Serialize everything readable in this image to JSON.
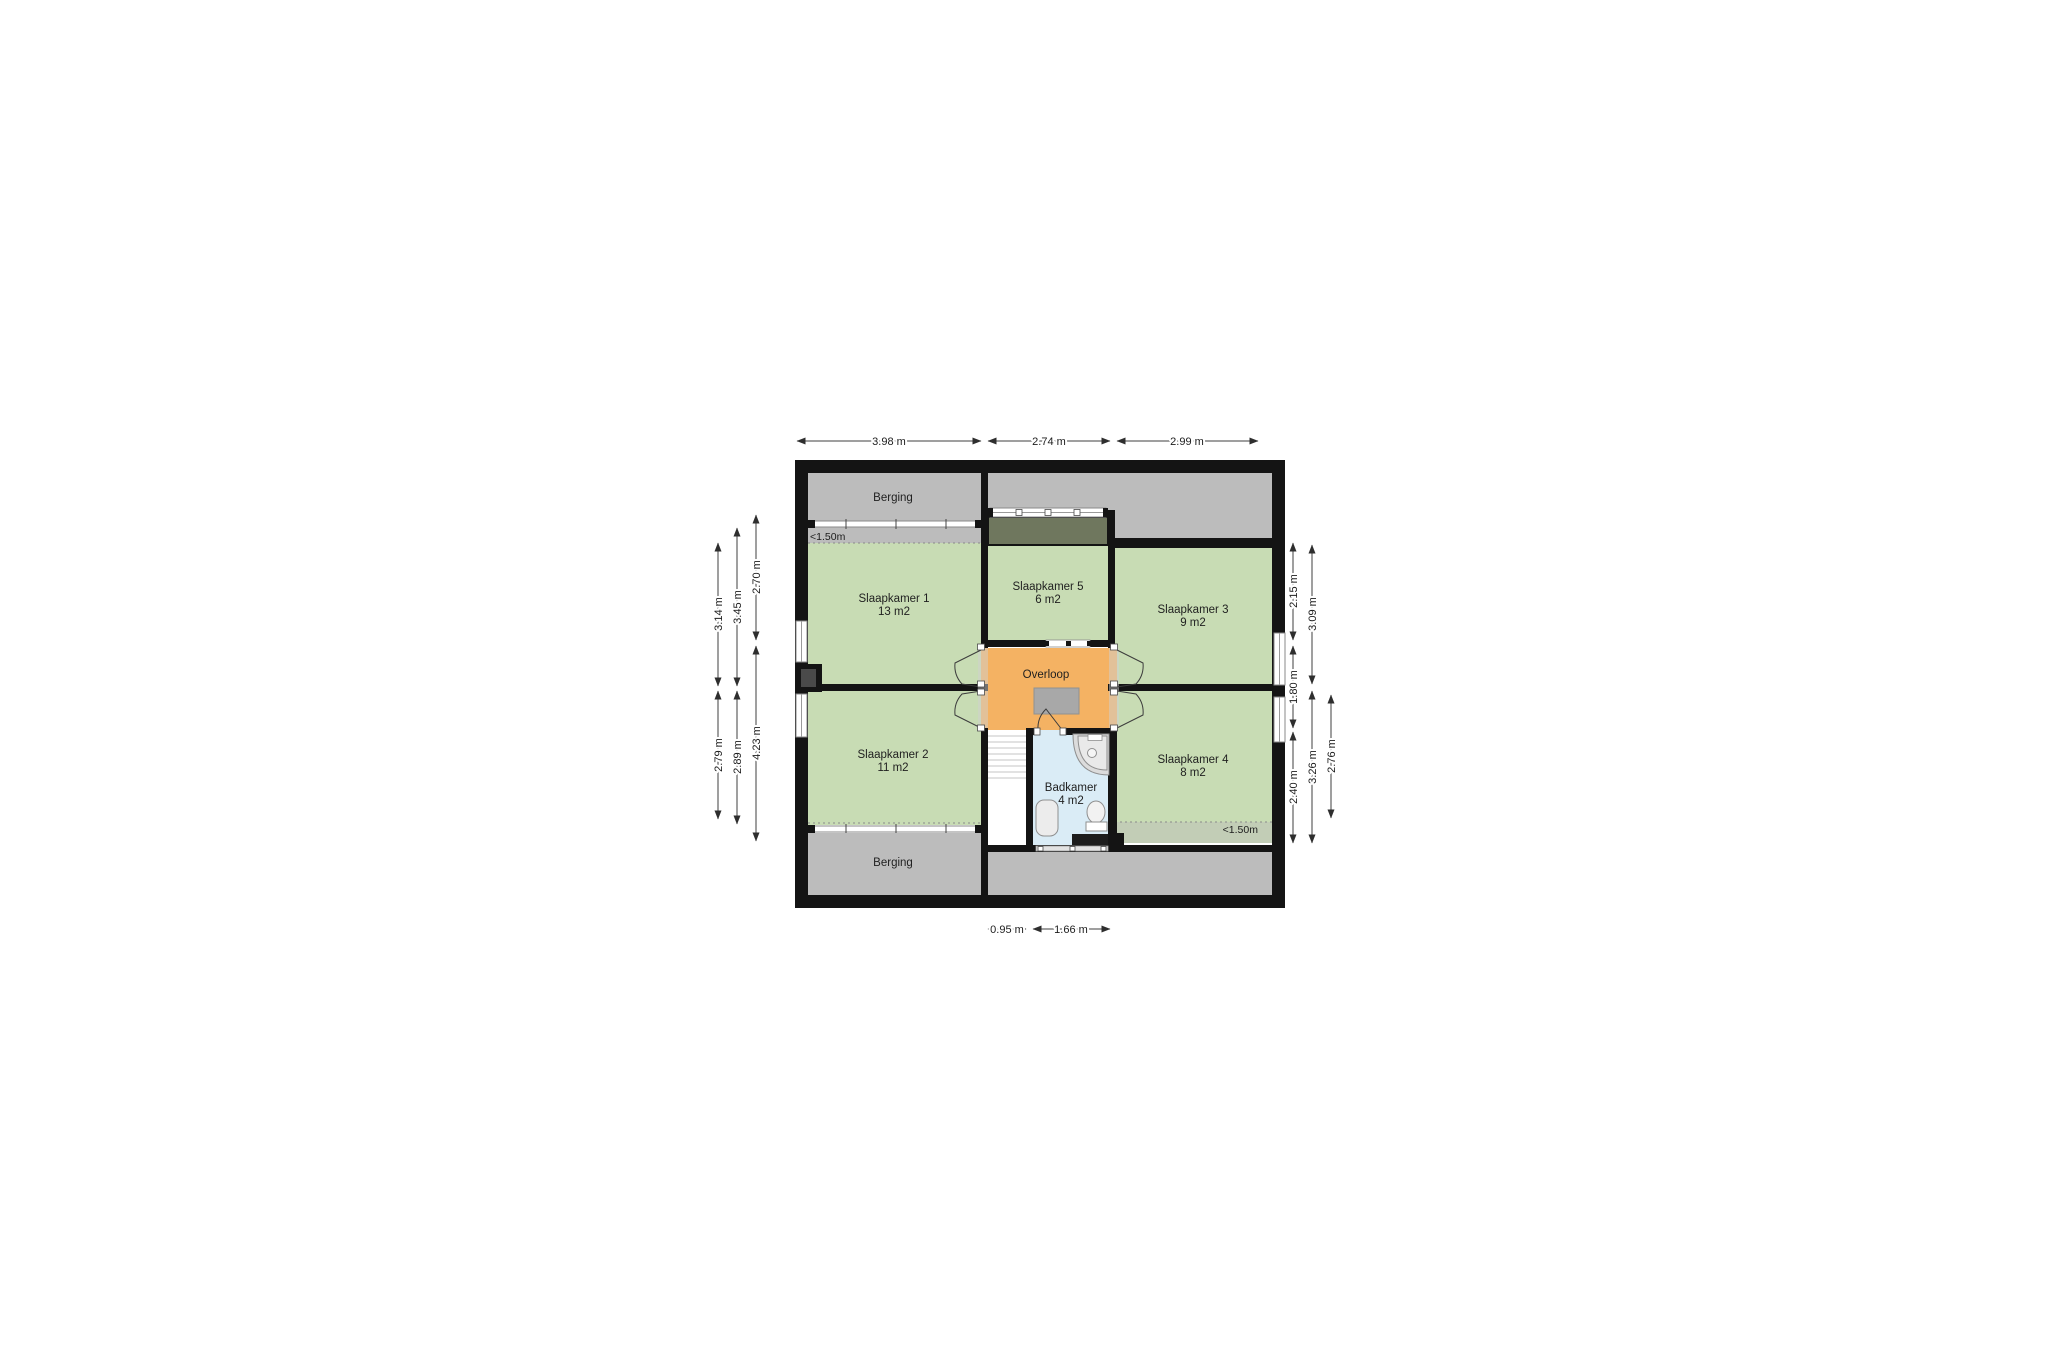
{
  "plan": {
    "rooms": {
      "berging_top": {
        "label": "Berging"
      },
      "berging_bottom": {
        "label": "Berging"
      },
      "slaapkamer_1": {
        "label": "Slaapkamer 1",
        "area": "13 m2"
      },
      "slaapkamer_2": {
        "label": "Slaapkamer 2",
        "area": "11 m2"
      },
      "slaapkamer_3": {
        "label": "Slaapkamer 3",
        "area": "9 m2"
      },
      "slaapkamer_4": {
        "label": "Slaapkamer 4",
        "area": "8 m2"
      },
      "slaapkamer_5": {
        "label": "Slaapkamer 5",
        "area": "6 m2"
      },
      "overloop": {
        "label": "Overloop"
      },
      "badkamer": {
        "label": "Badkamer",
        "area": "4 m2"
      }
    },
    "knee_wall_labels": {
      "top_left": "<1.50m",
      "bottom_right": "<1.50m"
    },
    "dimensions": {
      "top": [
        "3.98 m",
        "2.74 m",
        "2.99 m"
      ],
      "left_outer": [
        "3.14 m",
        "2.79 m"
      ],
      "left_middle": [
        "3.45 m",
        "2.89 m"
      ],
      "left_inner": [
        "2.70 m",
        "4.23 m"
      ],
      "right_inner": [
        "2.15 m",
        "1.80 m",
        "2.40 m"
      ],
      "right_middle": [
        "3.09 m",
        "3.26 m"
      ],
      "right_outer": [
        "2.76 m"
      ],
      "bottom": [
        "0.95 m",
        "1.66 m"
      ]
    },
    "colors": {
      "wall": "#141414",
      "room_green": "#c8dcb4",
      "room_green_muted": "#c2cdb6",
      "room_gray": "#bcbcbc",
      "hall_orange": "#f4b263",
      "bath_blue": "#daecf6",
      "dormer_olive": "#6f775e",
      "stair_void_gray": "#a8a8a8",
      "chimney_inner": "#4a4a4a",
      "radiator": "#1d1d1d"
    }
  }
}
